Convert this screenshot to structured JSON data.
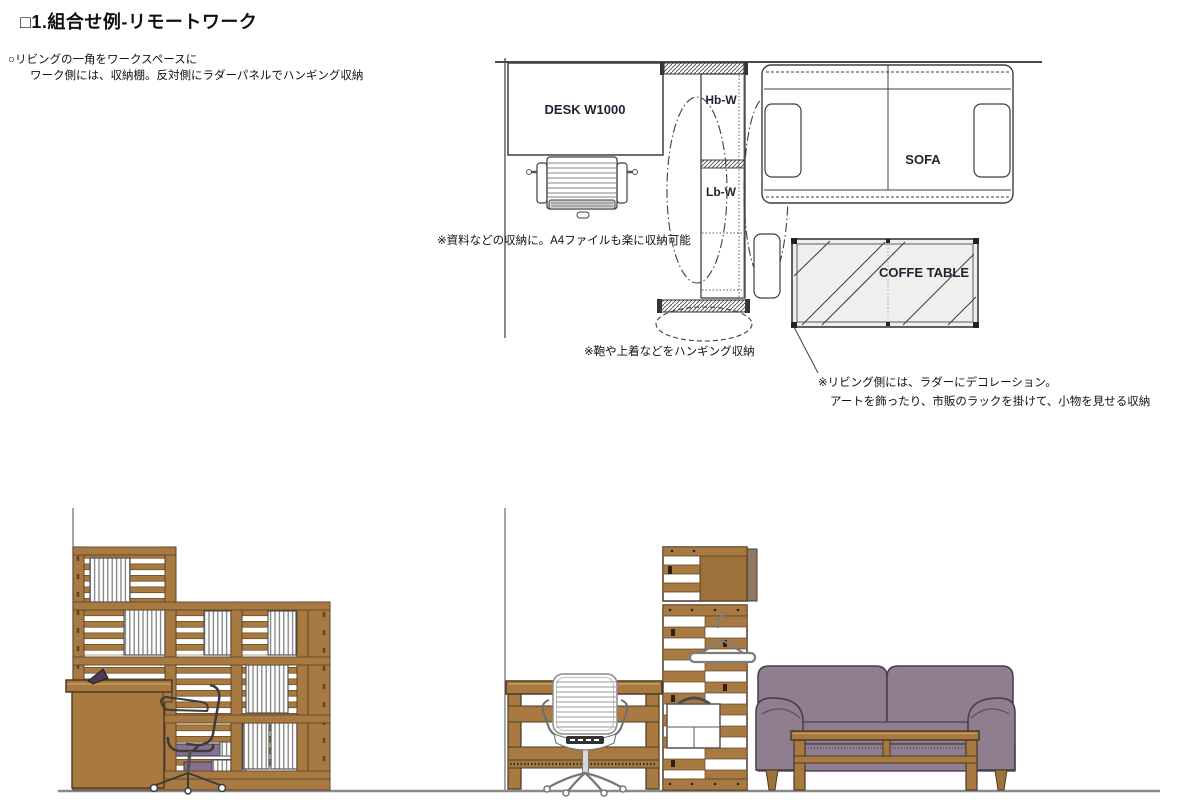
{
  "page": {
    "title": "□1.組合せ例-リモートワーク",
    "subtitle_line1": "○リビングの一角をワークスペースに",
    "subtitle_line2": "ワーク側には、収納棚。反対側にラダーパネルでハンギング収納"
  },
  "plan": {
    "desk_label": "DESK W1000",
    "shelf_upper_label": "Hb-W",
    "shelf_lower_label": "Lb-W",
    "sofa_label": "SOFA",
    "coffee_table_label": "COFFE TABLE",
    "annotations": {
      "storage": "※資料などの収納に。A4ファイルも楽に収納可能",
      "hanging": "※鞄や上着などをハンギング収納",
      "living_line1": "※リビング側には、ラダーにデコレーション。",
      "living_line2": "アートを飾ったり、市販のラックを掛けて、小物を見せる収納"
    }
  },
  "colors": {
    "wood": "#a87a42",
    "wood_dark_edge": "#5d442a",
    "wood_panel": "#9c713a",
    "sofa_purple": "#8e7e90",
    "sofa_outline": "#453b4b",
    "box_purple": "#867093",
    "drawing_line": "#3f3f3f",
    "floor_line": "#8a8a8a",
    "coffee_table_fill": "#f0efed"
  }
}
